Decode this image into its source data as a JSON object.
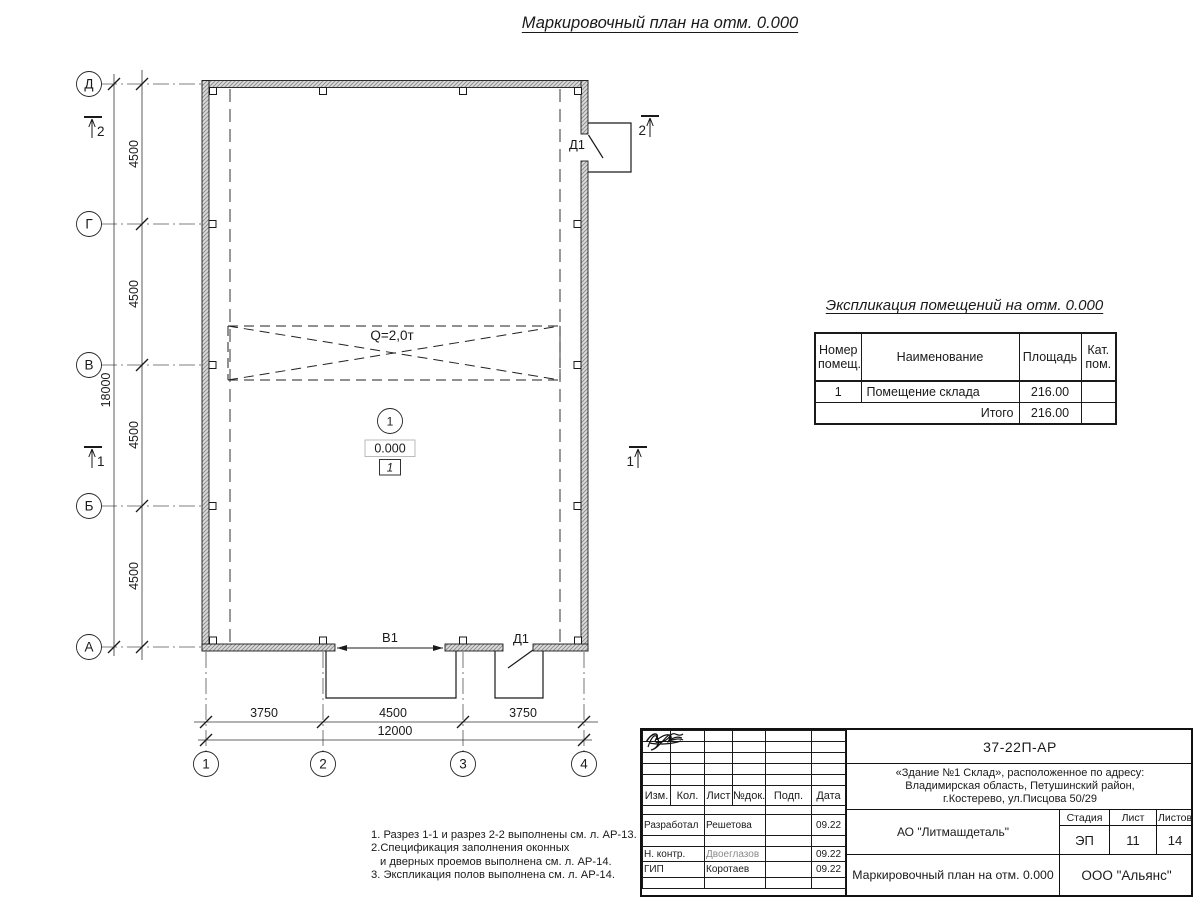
{
  "colors": {
    "line": "#1a1a1a",
    "wall_fill": "#dcdcdc",
    "wall_hatch": "#8f8f8f",
    "muted_text": "#8a8a8a"
  },
  "page_title": "Маркировочный план на отм. 0.000",
  "plan": {
    "row_axes": [
      "Д",
      "Г",
      "В",
      "Б",
      "А"
    ],
    "col_axes": [
      "1",
      "2",
      "3",
      "4"
    ],
    "left_dims": [
      "4500",
      "4500",
      "4500",
      "4500"
    ],
    "left_total_dim": "18000",
    "bottom_dims": [
      "3750",
      "4500",
      "3750"
    ],
    "bottom_total_dim": "12000",
    "crane_label": "Q=2,0т",
    "room_number": "1",
    "room_elevation": "0.000",
    "floor_type_mark": "1",
    "door_top_label": "Д1",
    "gate_label": "В1",
    "door_bottom_label": "Д1",
    "section_left_top": "2",
    "section_left_mid": "1",
    "section_right_mid": "1",
    "section_right_top": "2"
  },
  "explication": {
    "title": "Экспликация помещений на отм. 0.000",
    "col_headers": [
      "Номер помещ.",
      "Наименование",
      "Площадь",
      "Кат. пом."
    ],
    "rows": [
      {
        "number": "1",
        "name": "Помещение склада",
        "area": "216.00",
        "category": ""
      }
    ],
    "total_label": "Итого",
    "total_area": "216.00"
  },
  "notes": {
    "lines": [
      "1. Разрез 1-1 и разрез 2-2 выполнены см. л. АР-13.",
      "2.Спецификация заполнения оконных",
      "и дверных проемов выполнена см. л. АР-14.",
      "3. Экспликация полов выполнена см. л. АР-14."
    ]
  },
  "title_block": {
    "doc_number": "37-22П-АР",
    "object_lines": [
      "«Здание №1 Склад», расположенное по адресу:",
      "Владимирская область, Петушинский район,",
      "г.Костерево, ул.Писцова 50/29"
    ],
    "client": "АО \"Литмашдеталь\"",
    "stage_label": "Стадия",
    "sheet_label": "Лист",
    "sheets_label": "Листов",
    "stage": "ЭП",
    "sheet": "11",
    "sheets": "14",
    "drawing_title": "Маркировочный план на отм. 0.000",
    "company": "ООО \"Альянс\"",
    "rev_headers": [
      "Изм.",
      "Кол.",
      "Лист",
      "№док.",
      "Подп.",
      "Дата"
    ],
    "sign_rows": [
      {
        "role": "Разработал",
        "name": "Решетова",
        "date": "09.22"
      },
      {
        "role": "Н. контр.",
        "name": "Двоеглазов",
        "date": "09.22"
      },
      {
        "role": "ГИП",
        "name": "Коротаев",
        "date": "09.22"
      }
    ]
  }
}
